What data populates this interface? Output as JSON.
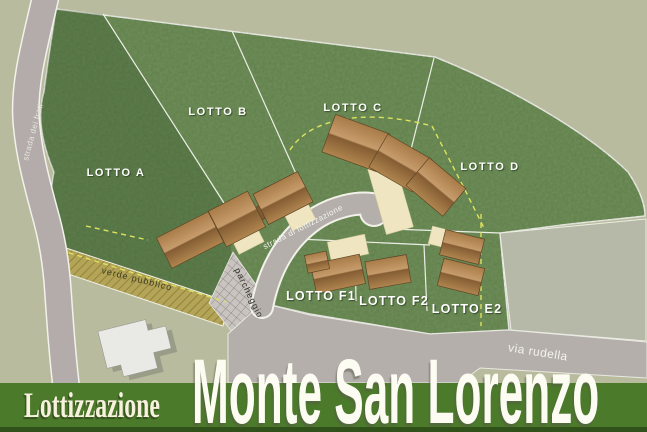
{
  "banner": {
    "prefix": "Lottizzazione",
    "title": "Monte San Lorenzo"
  },
  "lots": [
    {
      "id": "A",
      "label": "LOTTO A"
    },
    {
      "id": "B",
      "label": "LOTTO B"
    },
    {
      "id": "C",
      "label": "LOTTO C"
    },
    {
      "id": "D",
      "label": "LOTTO D"
    },
    {
      "id": "F1",
      "label": "LOTTO F1"
    },
    {
      "id": "F2",
      "label": "LOTTO F2"
    },
    {
      "id": "E2",
      "label": "LOTTO E2"
    }
  ],
  "roads": [
    {
      "id": "strada-dei-frati",
      "label": "strada dei frati"
    },
    {
      "id": "strada-di-lottizzazione",
      "label": "strada di lottizzazione"
    },
    {
      "id": "via-rudella",
      "label": "via rudella"
    }
  ],
  "areas": [
    {
      "id": "verde-pubblico",
      "label": "verde pubblico"
    },
    {
      "id": "parcheggio",
      "label": "parcheggio"
    }
  ],
  "colors": {
    "background": "#b8bb9d",
    "parcel_green": "#6f8f58",
    "banner_green": "#4c7a2b",
    "road_gray": "#b5afac",
    "roof_brown": "#b5854f",
    "driveway_cream": "#efe6c1",
    "hatch_olive": "#b3a458",
    "title_text": "#fdfcf2"
  }
}
